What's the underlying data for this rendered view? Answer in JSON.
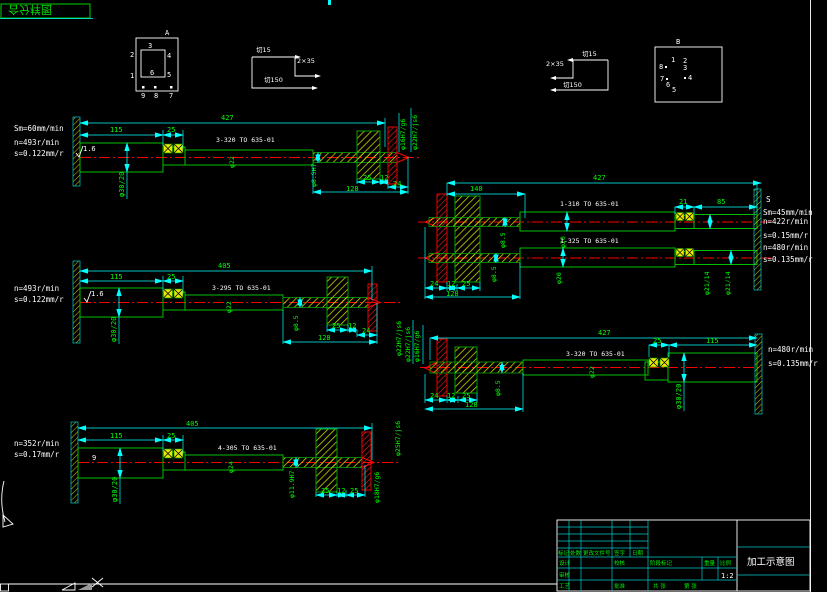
{
  "colors": {
    "background": "#000000",
    "dim_line": "#00ffff",
    "dim_text": "#00ff00",
    "centerline": "#ff0000",
    "hatch": "#ffff00",
    "annotation": "#ffffff"
  },
  "sheet": {
    "corner_title": "合分样图"
  },
  "detail_a": {
    "label": "A",
    "n1": "1",
    "n2": "2",
    "n3": "3",
    "n4": "4",
    "n5": "5",
    "n6": "6",
    "n7": "7",
    "n8": "8",
    "n9": "9"
  },
  "detail_b": {
    "label": "B",
    "n1": "1",
    "n2": "2",
    "n3": "3",
    "n4": "4",
    "n5": "5",
    "n6": "6",
    "n7": "7",
    "n8": "8"
  },
  "toolpath_left": {
    "a": "切15",
    "b": "2×35",
    "c": "切150"
  },
  "toolpath_right": {
    "a": "2×35",
    "b": "切15",
    "c": "切150"
  },
  "d1": {
    "feed": "Sm=60mm/min",
    "n": "n=493r/min",
    "s": "s=0.122mm/r",
    "rough": "1.6",
    "total": "427",
    "l1": "115",
    "l2": "25",
    "dia_step": "φ30/20",
    "proc": "3-320 TO 635-01",
    "dia": "φ22",
    "drill": "φ8.5H7",
    "w1": "25",
    "w2": "12",
    "w3": "24",
    "w4": "128",
    "fit1": "φ16H7/g6",
    "fit2": "φ22H7/js6"
  },
  "d2": {
    "total": "427",
    "l140": "140",
    "w1": "24",
    "w2": "12",
    "w3": "25",
    "w4": "128",
    "drill1": "φ8.5",
    "drill2": "φ8.5",
    "proc1": "1-310 TO 635-01",
    "proc2": "1-325 TO 635-01",
    "dia1": "φ20",
    "dia2": "φ20",
    "l21": "21",
    "l85": "85",
    "s_mark": "S",
    "feed": "Sm=45mm/min",
    "n1": "n=422r/min",
    "s1": "s=0.15mm/r",
    "n2": "n=480r/min",
    "s2": "s=0.135mm/r",
    "fit1": "φ21/14",
    "fit2": "φ21/14"
  },
  "d3": {
    "n": "n=493r/min",
    "s": "s=0.122mm/r",
    "rough": "1.6",
    "total": "405",
    "l1": "115",
    "l2": "25",
    "dia_step": "φ30/20",
    "proc": "3-295 TO 635-01",
    "dia": "φ22",
    "drill": "φ8.5",
    "w1": "25",
    "w2": "12",
    "w3": "24",
    "w4": "128",
    "fit": "φ22H7/js6"
  },
  "d4": {
    "total": "427",
    "l1": "115",
    "l2": "25",
    "dia_step": "φ30/20",
    "proc": "3-320 TO 635-01",
    "dia": "φ22",
    "drill": "φ8.5",
    "w1": "24",
    "w2": "12",
    "w3": "25",
    "w4": "128",
    "fit1": "φ22H7/js6",
    "fit2": "φ16H7/g6",
    "n": "n=480r/min",
    "s": "s=0.135mm/r"
  },
  "d5": {
    "n": "n=352r/min",
    "s": "s=0.17mm/r",
    "mark": "9",
    "total": "405",
    "l1": "115",
    "l2": "25",
    "dia_step": "φ30/20",
    "proc": "4-305 TO 635-01",
    "dia": "φ24",
    "drill": "φ11.9H7",
    "w1": "25",
    "w2": "12",
    "w3": "25",
    "fit1": "φ18H7/g6",
    "fit2": "φ25H7/js6"
  },
  "titleblock": {
    "r1c1": "标记",
    "r1c2": "处数",
    "r1c3": "更改文件号",
    "r1c4": "签字",
    "r1c5": "日期",
    "design": "设计",
    "check": "校核",
    "audit": "审核",
    "process": "工艺",
    "approve": "批准",
    "stage": "阶段标记",
    "weight": "重量",
    "scale_label": "比例",
    "scale_value": "1:2",
    "sheets_total": "共 张",
    "sheet_no": "第 张",
    "title": "加工示意图"
  }
}
